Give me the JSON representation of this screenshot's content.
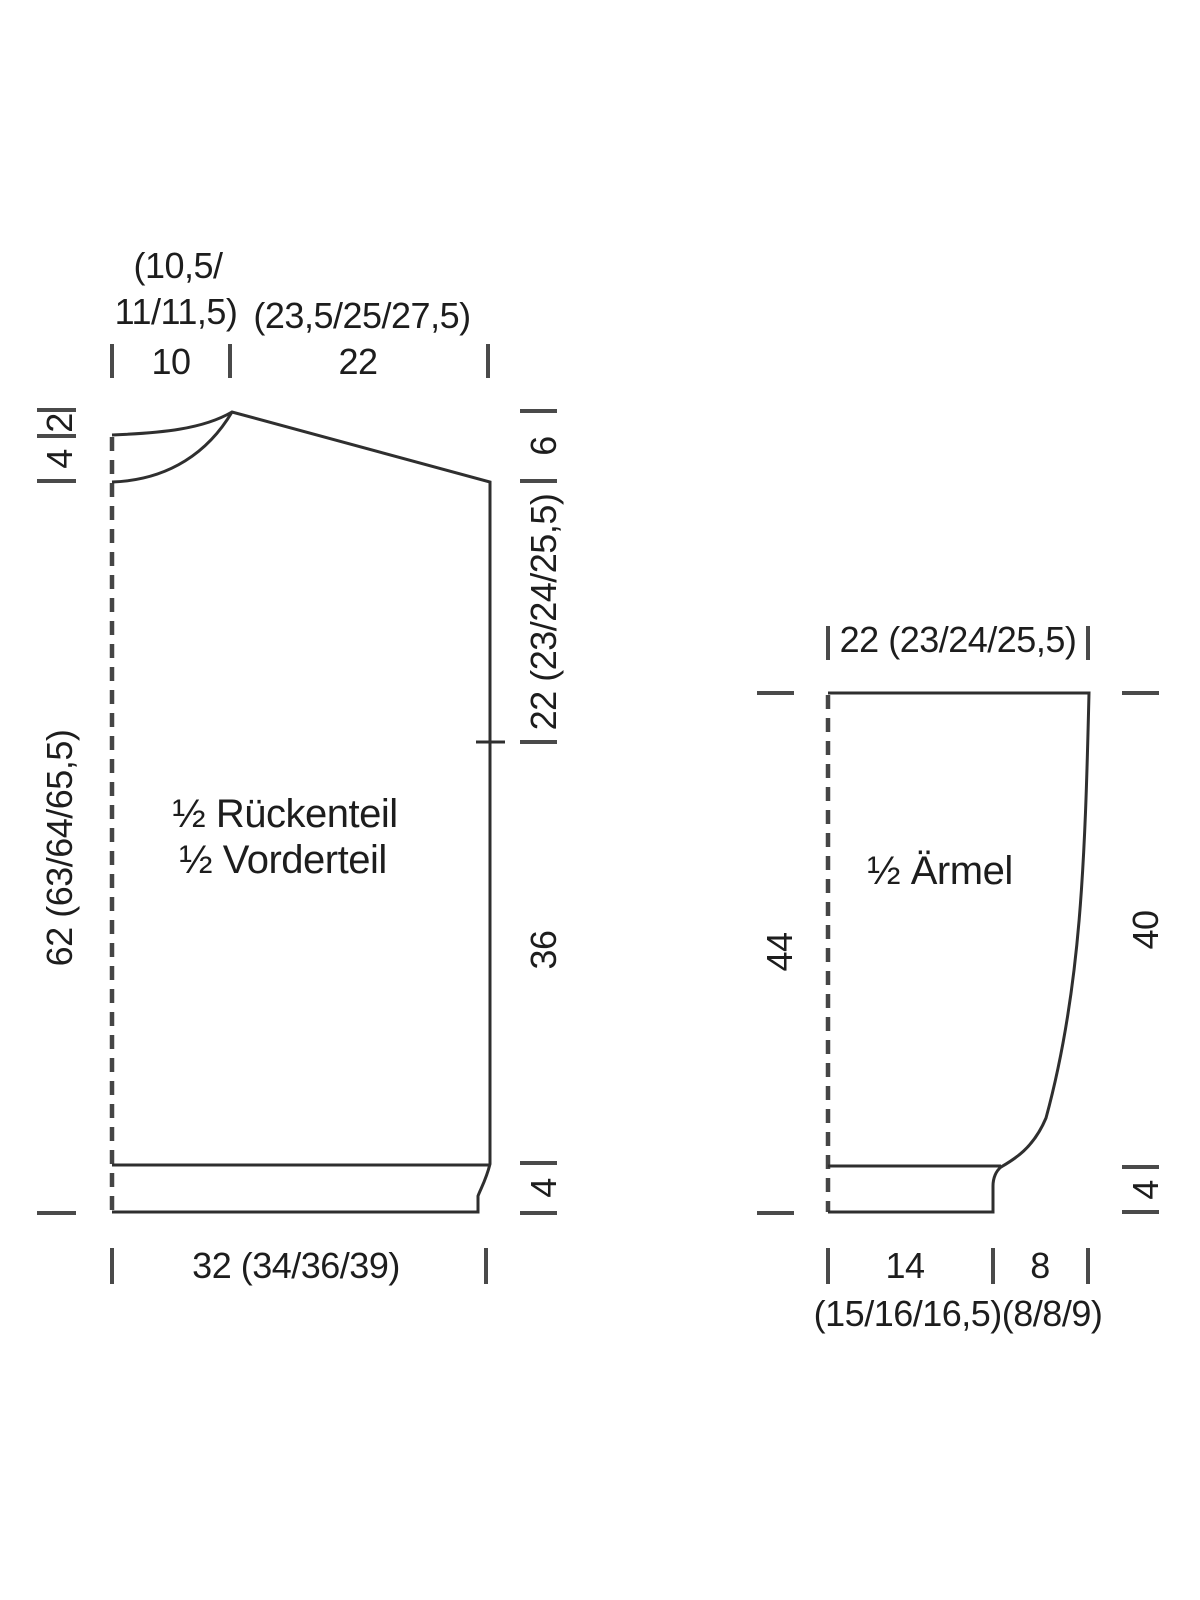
{
  "body_piece": {
    "name_line1": "½ Rückenteil",
    "name_line2": "½ Vorderteil",
    "top_neck_sizes_line1": "(10,5/",
    "top_neck_sizes_line2": "11/11,5)",
    "top_neck_width": "10",
    "top_shoulder_sizes": "(23,5/25/27,5)",
    "top_shoulder_width": "22",
    "left_front_neck_depth": "4",
    "left_back_neck_depth": "2",
    "left_length": "62 (63/64/65,5)",
    "right_shoulder_slope": "6",
    "right_armhole_depth": "22 (23/24/25,5)",
    "right_side_length": "36",
    "right_ribbing_height": "4",
    "bottom_width": "32 (34/36/39)"
  },
  "sleeve_piece": {
    "name": "½ Ärmel",
    "top_width": "22 (23/24/25,5)",
    "left_length": "44",
    "right_upper_length": "40",
    "right_ribbing_height": "4",
    "bottom_cuff_width": "14",
    "bottom_cuff_sizes": "(15/16/16,5)",
    "bottom_ext_width": "8",
    "bottom_ext_sizes": "(8/8/9)"
  }
}
